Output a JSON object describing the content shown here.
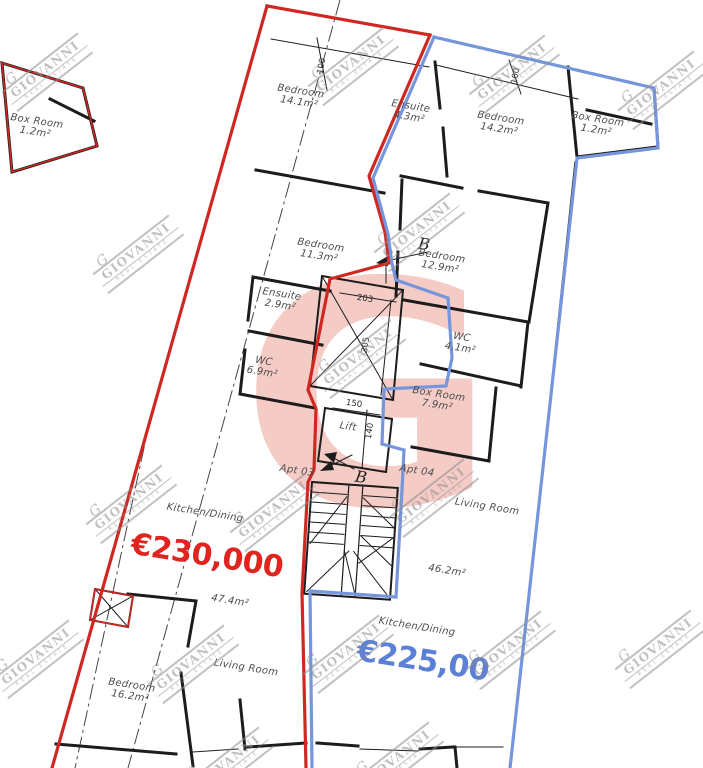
{
  "plan": {
    "brand_watermark": {
      "monogram": "G",
      "brand": "GIOVANNI",
      "tagline": "REAL ESTATE"
    },
    "colors": {
      "apt03_outline": "#cf2721",
      "apt03_price": "#e02420",
      "apt04_outline": "#7595dc",
      "apt04_price": "#5c80d6",
      "walls": "#1c1c1c",
      "logo_pink": "#e77d70"
    },
    "apartments": [
      {
        "id": "apt-03",
        "label": "Apt 03",
        "price": "€230,000",
        "price_x": 207,
        "price_y": 556,
        "price_color": "#e02420"
      },
      {
        "id": "apt-04",
        "label": "Apt 04",
        "price": "€225,00",
        "price_x": 423,
        "price_y": 661,
        "price_color": "#5c80d6"
      }
    ],
    "rooms": [
      {
        "label": "Box Room",
        "area": "1.2m²",
        "x": 36,
        "y": 127
      },
      {
        "label": "Bedroom",
        "area": "14.1m²",
        "x": 300,
        "y": 97
      },
      {
        "label": "Ensuite",
        "area": "4.3m²",
        "x": 410,
        "y": 112
      },
      {
        "label": "Bedroom",
        "area": "14.2m²",
        "x": 500,
        "y": 124
      },
      {
        "label": "Box Room",
        "area": "1.2m²",
        "x": 597,
        "y": 125
      },
      {
        "label": "Bedroom",
        "area": "11.3m²",
        "x": 320,
        "y": 251
      },
      {
        "label": "Bedroom",
        "area": "12.9m²",
        "x": 441,
        "y": 262
      },
      {
        "label": "Ensuite",
        "area": "2.9m²",
        "x": 281,
        "y": 300
      },
      {
        "label": "WC",
        "area": "6.9m²",
        "x": 263,
        "y": 367
      },
      {
        "label": "WC",
        "area": "4.1m²",
        "x": 461,
        "y": 343
      },
      {
        "label": "Box Room",
        "area": "7.9m²",
        "x": 438,
        "y": 400
      },
      {
        "label": "Lift",
        "area": "",
        "x": 348,
        "y": 427
      },
      {
        "label": "Apt 03",
        "area": "",
        "x": 297,
        "y": 471
      },
      {
        "label": "Apt 04",
        "area": "",
        "x": 417,
        "y": 471
      },
      {
        "label": "Living Room",
        "area": "",
        "x": 487,
        "y": 507
      },
      {
        "label": "Kitchen/Dining",
        "area": "",
        "x": 205,
        "y": 513
      },
      {
        "label": "47.4m²",
        "area": "",
        "x": 230,
        "y": 601
      },
      {
        "label": "46.2m²",
        "area": "",
        "x": 447,
        "y": 571
      },
      {
        "label": "Kitchen/Dining",
        "area": "",
        "x": 417,
        "y": 627
      },
      {
        "label": "Living Room",
        "area": "",
        "x": 246,
        "y": 668
      },
      {
        "label": "Bedroom",
        "area": "16.2m²",
        "x": 131,
        "y": 691
      }
    ],
    "markers": [
      {
        "text": "B",
        "x": 424,
        "y": 244
      },
      {
        "text": "B",
        "x": 361,
        "y": 477
      }
    ],
    "dimensions": [
      {
        "text": "100",
        "x": 322,
        "y": 66,
        "rot": -80
      },
      {
        "text": "100",
        "x": 516,
        "y": 76,
        "rot": -80
      },
      {
        "text": "203",
        "x": 365,
        "y": 299,
        "rot": 9
      },
      {
        "text": "305",
        "x": 366,
        "y": 345,
        "rot": -81
      },
      {
        "text": "150",
        "x": 354,
        "y": 404,
        "rot": 9
      },
      {
        "text": "140",
        "x": 370,
        "y": 431,
        "rot": -81
      }
    ],
    "watermarks": {
      "positions": [
        [
          44,
          68
        ],
        [
          350,
          62
        ],
        [
          511,
          70
        ],
        [
          660,
          86
        ],
        [
          135,
          250
        ],
        [
          416,
          228
        ],
        [
          357,
          355
        ],
        [
          128,
          500
        ],
        [
          272,
          508
        ],
        [
          430,
          494
        ],
        [
          190,
          660
        ],
        [
          345,
          650
        ],
        [
          507,
          646
        ],
        [
          657,
          645
        ],
        [
          35,
          655
        ],
        [
          225,
          762
        ],
        [
          395,
          757
        ]
      ]
    }
  }
}
